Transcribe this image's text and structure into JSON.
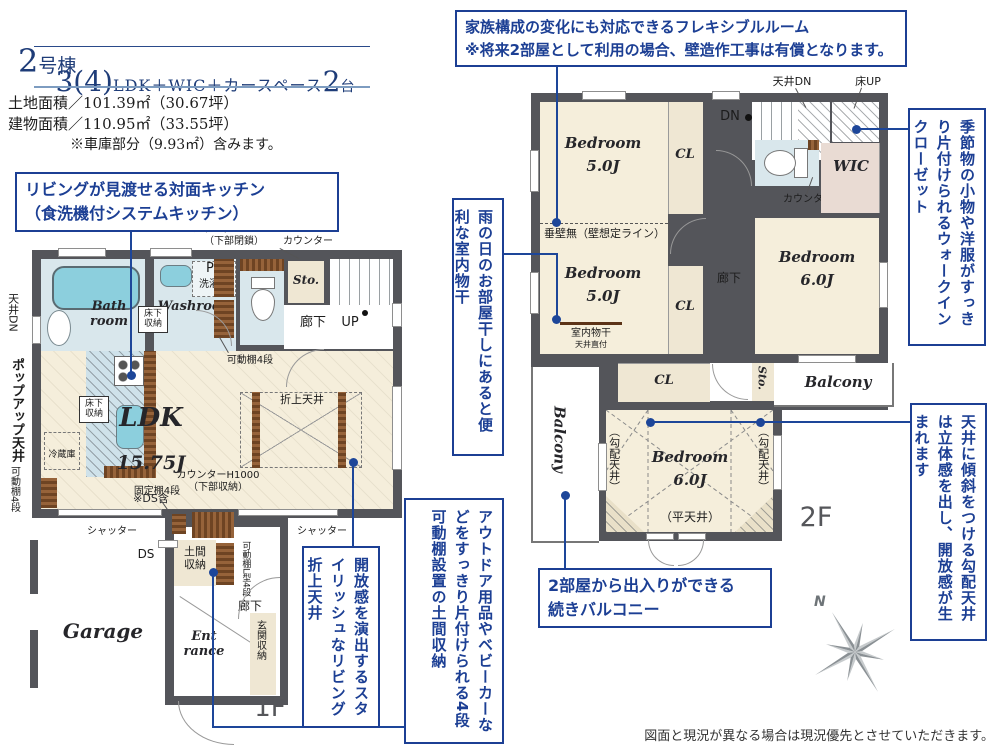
{
  "header": {
    "building_no": "2",
    "building_suffix": "号棟",
    "plan_num": "3(4)",
    "plan_mid": "LDK＋WIC＋カースペース",
    "plan_count": "2",
    "plan_count_suffix": "台",
    "land_area": "土地面積／101.39㎡（30.67坪）",
    "building_area": "建物面積／110.95㎡（33.55坪）",
    "garage_note": "※車庫部分（9.93㎡）含みます。"
  },
  "callouts": {
    "flexible": "家族構成の変化にも対応できるフレキシブルルーム\n※将来2部屋として利用の場合、壁造作工事は有償となります。",
    "kitchen": "リビングが見渡せる対面キッチン\n（食洗機付システムキッチン）",
    "drying": "雨の日のお部屋干しにあると便利な室内物干",
    "doma": "アウトドア用品やベビーカーなどをすっきり片付けられる4段可動棚設置の土間収納",
    "coffered": "開放感を演出するスタイリッシュなリビング折上天井",
    "wic": "季節物の小物や洋服がすっきり片付けられるウォークインクローゼット",
    "slope": "天井に傾斜をつける勾配天井は立体感を出し、開放感が生まれます",
    "balcony": "2部屋から出入りができる\n続きバルコニー"
  },
  "f1": {
    "bath": "Bath\nroom",
    "washroom": "Washroom",
    "ps": "PS",
    "washer": "洗濯機",
    "underfloor": "床下\n収納",
    "counter_closed": "カウンターH1000\n（下部閉鎖）",
    "counter": "カウンター",
    "shelf4": "可動棚4段",
    "sto": "Sto.",
    "hallway": "廊下",
    "up": "UP",
    "ldk_name": "LDK",
    "ldk_size": "15.75J",
    "ldk_note": "※DS含",
    "oriage": "折上天井",
    "fridge": "冷蔵庫",
    "ceiling_dn": "天井DN",
    "popup": "ポップアップ天井",
    "counter_storage": "カウンターH1000\n（下部収納）",
    "fixed_shelf": "固定棚4段",
    "shutter": "シャッター",
    "ds": "DS",
    "doma": "土間\n収納",
    "shelf_l4": "可動棚L型4段",
    "hallway2": "廊下",
    "entrance": "Ent\nrance",
    "genkan": "玄関収納",
    "garage": "Garage",
    "label": "1F"
  },
  "f2": {
    "bedroom5": "Bedroom\n5.0J",
    "bedroom6": "Bedroom\n6.0J",
    "cl": "CL",
    "ceiling_dn": "天井DN",
    "floor_up": "床UP",
    "dn": "DN",
    "wic": "WIC",
    "counter": "カウンター",
    "tarekabe": "垂壁無（壁想定ライン）",
    "monohoshi": "室内物干",
    "ceiling_mount": "天井直付",
    "hallway": "廊下",
    "sto": "Sto.",
    "balcony": "Balcony",
    "slope": "（勾配天井）",
    "flat": "（平天井）",
    "label": "2F"
  },
  "compass": {
    "n": "N"
  },
  "footer": "図面と現況が異なる場合は現況優先とさせていただきます。"
}
